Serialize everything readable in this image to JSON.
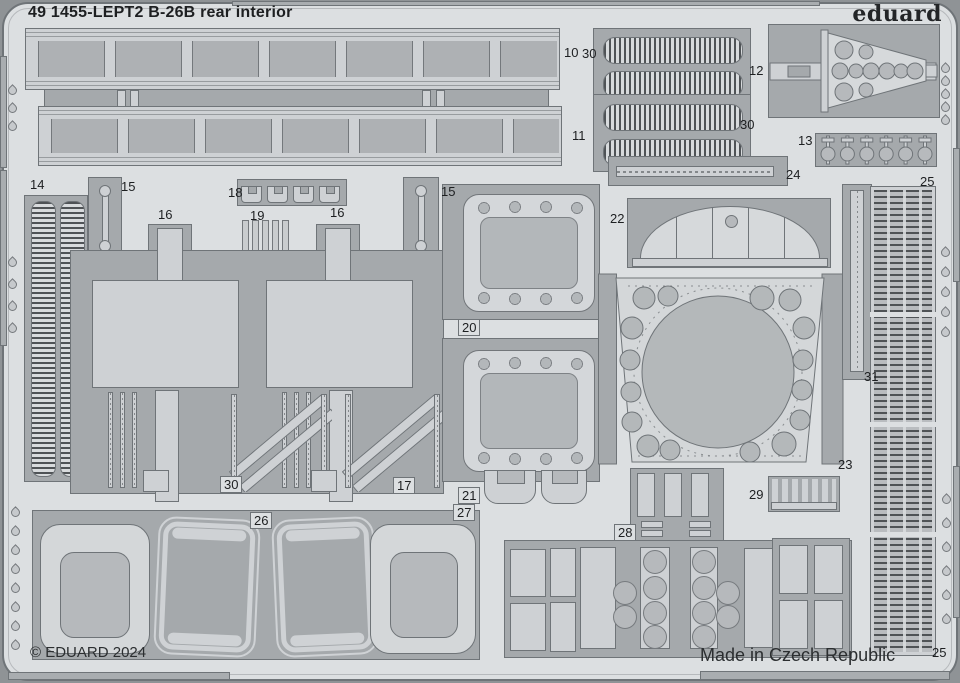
{
  "header": {
    "title": "49 1455-LEPT2  B-26B rear interior",
    "brand_logo": "eduard"
  },
  "footer": {
    "copyright": "© EDUARD 2024",
    "origin": "Made in Czech Republic"
  },
  "colors": {
    "background": "#8f9396",
    "sheet": "#dcdfe1",
    "part_backing": "#a5a9ac",
    "part_light": "#ced1d4",
    "part_mid": "#b6b9bc",
    "outline": "#6f7478",
    "text": "#1d1f21"
  },
  "sheet": {
    "description": "Eduard photo-etched fret with numbered parts",
    "part_labels": [
      {
        "text": "10",
        "x": 564,
        "y": 45
      },
      {
        "text": "30",
        "x": 582,
        "y": 46
      },
      {
        "text": "12",
        "x": 749,
        "y": 63
      },
      {
        "text": "30",
        "x": 740,
        "y": 117
      },
      {
        "text": "11",
        "x": 572,
        "y": 128
      },
      {
        "text": "13",
        "x": 798,
        "y": 133
      },
      {
        "text": "25",
        "x": 920,
        "y": 174
      },
      {
        "text": "24",
        "x": 786,
        "y": 167
      },
      {
        "text": "14",
        "x": 30,
        "y": 177
      },
      {
        "text": "15",
        "x": 121,
        "y": 179
      },
      {
        "text": "15",
        "x": 441,
        "y": 184
      },
      {
        "text": "18",
        "x": 228,
        "y": 185
      },
      {
        "text": "16",
        "x": 158,
        "y": 207
      },
      {
        "text": "19",
        "x": 250,
        "y": 208
      },
      {
        "text": "16",
        "x": 330,
        "y": 205
      },
      {
        "text": "22",
        "x": 610,
        "y": 211
      },
      {
        "text": "20",
        "x": 458,
        "y": 319,
        "boxed": true
      },
      {
        "text": "31",
        "x": 864,
        "y": 369
      },
      {
        "text": "30",
        "x": 220,
        "y": 476,
        "boxed": true
      },
      {
        "text": "17",
        "x": 393,
        "y": 477,
        "boxed": true
      },
      {
        "text": "21",
        "x": 458,
        "y": 487,
        "boxed": true
      },
      {
        "text": "23",
        "x": 838,
        "y": 457
      },
      {
        "text": "29",
        "x": 749,
        "y": 487
      },
      {
        "text": "26",
        "x": 250,
        "y": 512,
        "boxed": true
      },
      {
        "text": "27",
        "x": 453,
        "y": 504,
        "boxed": true
      },
      {
        "text": "28",
        "x": 614,
        "y": 524,
        "boxed": true
      },
      {
        "text": "25",
        "x": 932,
        "y": 645
      }
    ]
  }
}
